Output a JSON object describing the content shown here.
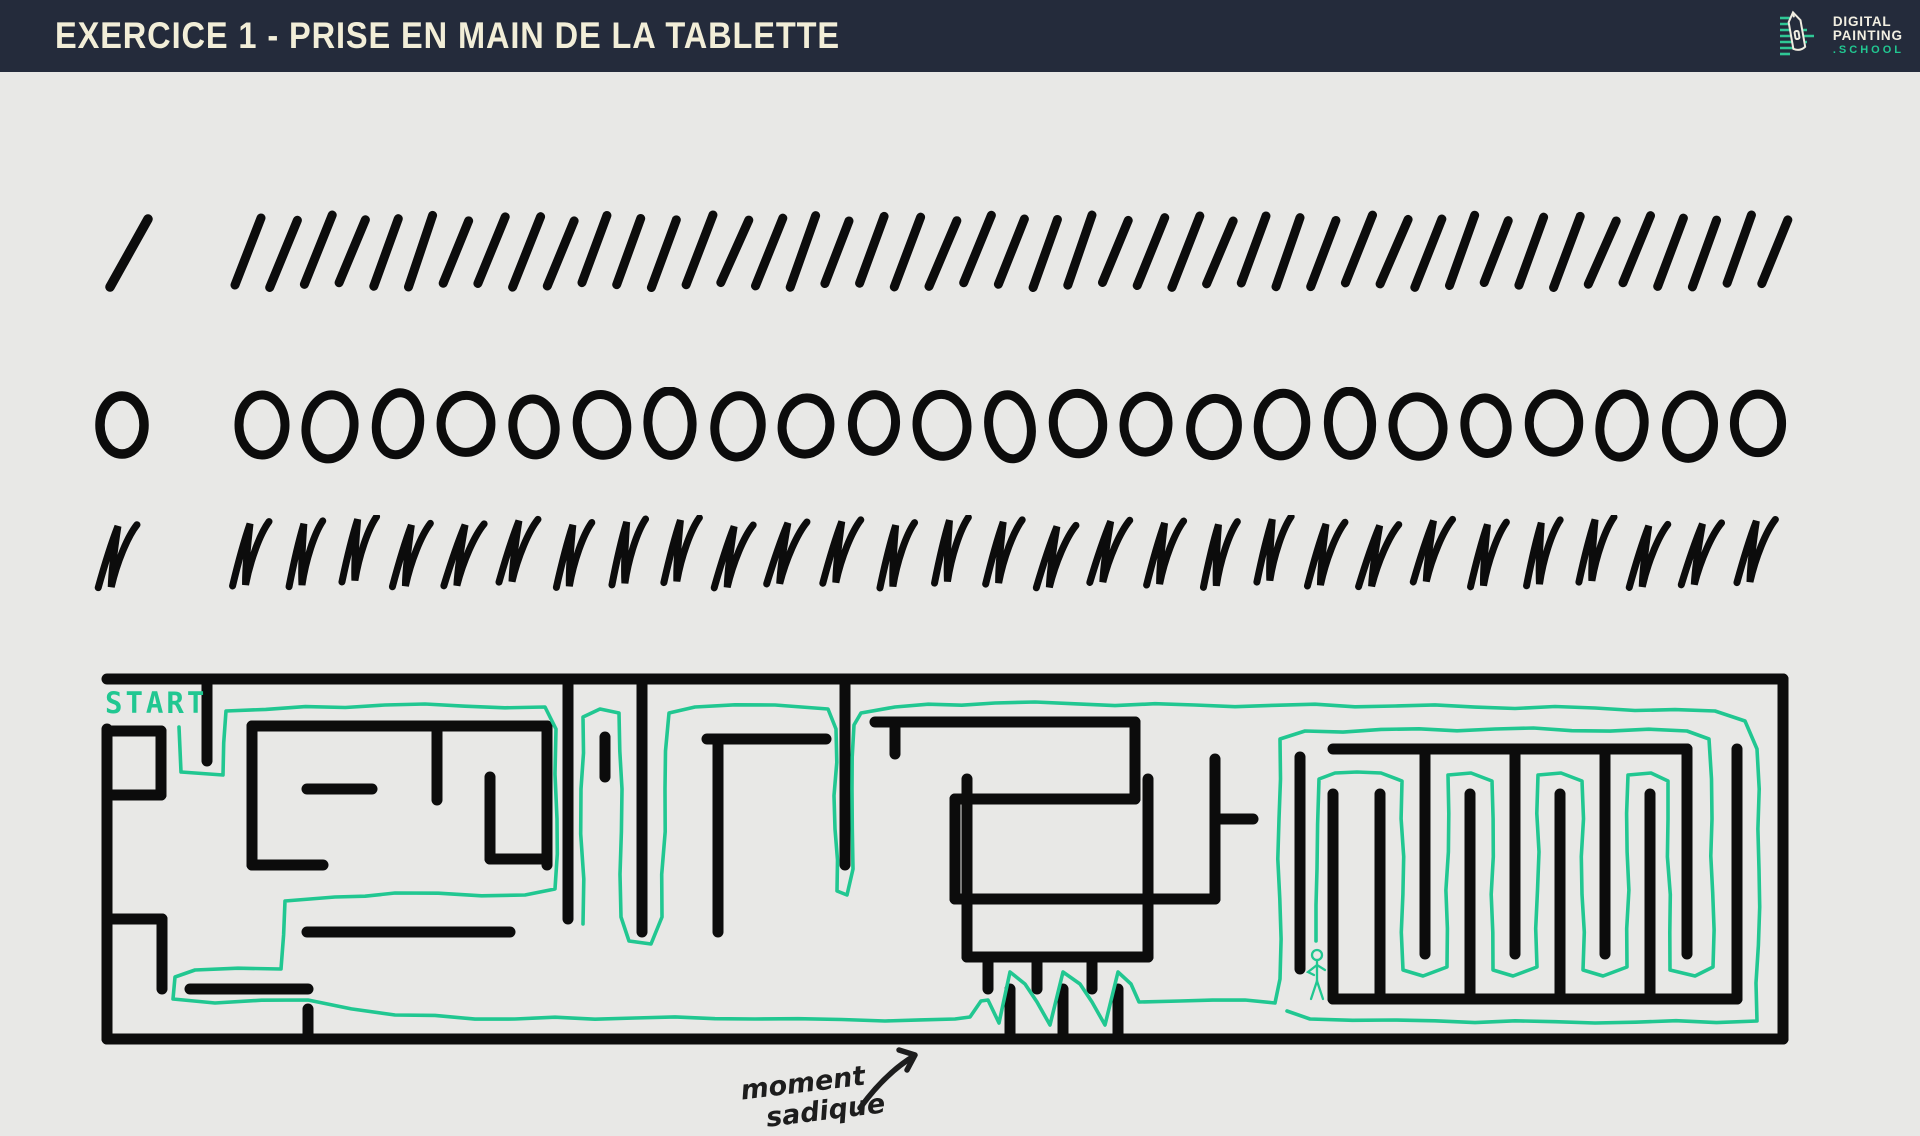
{
  "header": {
    "title": "EXERCICE 1 - PRISE EN MAIN DE LA TABLETTE",
    "logo": {
      "line1": "DIGITAL",
      "line2": "PAINTING",
      "line3": ".SCHOOL"
    }
  },
  "colors": {
    "background": "#e8e8e6",
    "ink": "#0c0c0c",
    "accent": "#21c791",
    "header_bg": "#242b3b",
    "header_fg": "#f2eed8"
  },
  "practice_rows": [
    {
      "name": "slash-strokes",
      "type": "slash",
      "single_count": 1,
      "group_count": 45
    },
    {
      "name": "circle-strokes",
      "type": "circle",
      "single_count": 1,
      "group_count": 23
    },
    {
      "name": "n-strokes",
      "type": "n",
      "single_count": 1,
      "group_count": 29
    }
  ],
  "maze": {
    "start_label": "START",
    "annotation": {
      "line1": "moment",
      "line2": "sadique"
    },
    "figure": {
      "x": 1222,
      "y": 304
    },
    "walls": [
      "M12,10 H1688",
      "M1688,10 V370",
      "M12,370 H1688",
      "M12,60 V370",
      "M112,10 V92",
      "M12,62 H66",
      "M66,62 V126",
      "M12,126 H66",
      "M157,57 H452",
      "M157,57 V196",
      "M157,196 H228",
      "M212,120 H277",
      "M342,57 V131",
      "M395,108 V190",
      "M395,190 H452",
      "M452,57 V196",
      "M12,250 H67",
      "M67,250 V320",
      "M95,320 H213",
      "M213,340 V370",
      "M212,263 H415",
      "M473,10 V250",
      "M510,68 V108",
      "M547,10 V263",
      "M612,70 H731",
      "M623,70 V263",
      "M750,10 V196",
      "M780,53 H1040",
      "M800,53 V85",
      "M1040,53 V130",
      "M860,130 H1040",
      "M860,130 V230",
      "M860,230 H1120",
      "M1120,230 V90",
      "M1120,150 H1158",
      "M872,110 V288",
      "M872,288 H1053",
      "M1053,110 V288",
      "M893,288 V320",
      "M942,288 V320",
      "M997,288 V320",
      "M915,370 V320",
      "M968,370 V320",
      "M1023,370 V320",
      "M1205,88 V300",
      "M1238,80 H1592",
      "M1592,80 V285",
      "M1642,80 V330",
      "M1238,330 H1642",
      "M1238,125 V330",
      "M1330,80 V285",
      "M1420,80 V285",
      "M1510,80 V285",
      "M1285,330 V125",
      "M1375,330 V125",
      "M1465,330 V125",
      "M1555,330 V125"
    ],
    "solution_segments": [
      [
        [
          84,
          58
        ],
        [
          86,
          103
        ],
        [
          128,
          106
        ],
        [
          131,
          42
        ],
        [
          290,
          36
        ],
        [
          450,
          38
        ],
        [
          461,
          60
        ],
        [
          462,
          150
        ],
        [
          460,
          220
        ],
        [
          430,
          226
        ],
        [
          300,
          224
        ],
        [
          240,
          228
        ],
        [
          190,
          232
        ],
        [
          186,
          300
        ],
        [
          100,
          301
        ],
        [
          80,
          308
        ],
        [
          78,
          330
        ],
        [
          120,
          334
        ],
        [
          213,
          331
        ],
        [
          300,
          346
        ],
        [
          420,
          350
        ],
        [
          540,
          349
        ],
        [
          660,
          350
        ],
        [
          790,
          352
        ],
        [
          860,
          350
        ],
        [
          875,
          348
        ],
        [
          886,
          332
        ],
        [
          893,
          331
        ],
        [
          904,
          354
        ],
        [
          915,
          303
        ],
        [
          930,
          315
        ],
        [
          942,
          333
        ],
        [
          955,
          356
        ],
        [
          968,
          303
        ],
        [
          985,
          315
        ],
        [
          997,
          333
        ],
        [
          1010,
          356
        ],
        [
          1023,
          303
        ],
        [
          1036,
          315
        ],
        [
          1044,
          333
        ],
        [
          1085,
          332
        ],
        [
          1150,
          331
        ],
        [
          1180,
          334
        ],
        [
          1185,
          310
        ],
        [
          1184,
          150
        ],
        [
          1185,
          70
        ],
        [
          1210,
          62
        ],
        [
          1400,
          60
        ],
        [
          1592,
          62
        ],
        [
          1614,
          70
        ],
        [
          1617,
          150
        ],
        [
          1618,
          298
        ],
        [
          1600,
          307
        ],
        [
          1575,
          301
        ],
        [
          1573,
          150
        ],
        [
          1573,
          112
        ],
        [
          1556,
          104
        ],
        [
          1533,
          106
        ],
        [
          1532,
          298
        ],
        [
          1508,
          307
        ],
        [
          1488,
          301
        ],
        [
          1487,
          112
        ],
        [
          1466,
          104
        ],
        [
          1443,
          106
        ],
        [
          1442,
          298
        ],
        [
          1418,
          307
        ],
        [
          1398,
          301
        ],
        [
          1397,
          112
        ],
        [
          1376,
          104
        ],
        [
          1353,
          106
        ],
        [
          1352,
          298
        ],
        [
          1328,
          307
        ],
        [
          1308,
          301
        ],
        [
          1307,
          112
        ],
        [
          1286,
          104
        ],
        [
          1262,
          103
        ],
        [
          1240,
          104
        ],
        [
          1224,
          110
        ],
        [
          1222,
          200
        ],
        [
          1221,
          272
        ]
      ],
      [
        [
          488,
          255
        ],
        [
          486,
          120
        ],
        [
          488,
          48
        ],
        [
          505,
          40
        ],
        [
          524,
          44
        ],
        [
          527,
          120
        ],
        [
          526,
          248
        ],
        [
          534,
          272
        ],
        [
          556,
          275
        ],
        [
          567,
          248
        ],
        [
          570,
          120
        ],
        [
          574,
          44
        ],
        [
          600,
          38
        ],
        [
          680,
          36
        ],
        [
          733,
          40
        ],
        [
          741,
          60
        ],
        [
          740,
          160
        ],
        [
          742,
          222
        ],
        [
          752,
          226
        ],
        [
          758,
          200
        ],
        [
          757,
          120
        ],
        [
          759,
          56
        ],
        [
          766,
          44
        ],
        [
          800,
          38
        ],
        [
          900,
          34
        ],
        [
          1100,
          36
        ],
        [
          1300,
          37
        ],
        [
          1500,
          39
        ],
        [
          1620,
          42
        ],
        [
          1650,
          52
        ],
        [
          1662,
          80
        ],
        [
          1664,
          200
        ],
        [
          1662,
          352
        ],
        [
          1500,
          354
        ],
        [
          1300,
          351
        ],
        [
          1215,
          350
        ],
        [
          1192,
          342
        ]
      ]
    ]
  }
}
